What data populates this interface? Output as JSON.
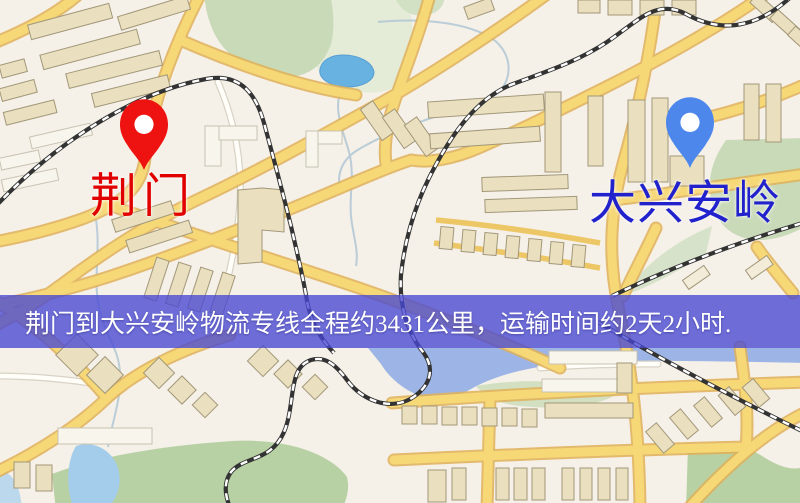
{
  "map": {
    "markers": [
      {
        "role": "origin",
        "name": "荆门",
        "pin_color": "#ee1311",
        "label_color": "#e10000",
        "pin_icon": "red-map-pin"
      },
      {
        "role": "destination",
        "name": "大兴安岭",
        "pin_color": "#4e87ec",
        "label_color": "#2222cc",
        "pin_icon": "blue-map-pin"
      }
    ],
    "banner": {
      "text": "荆门到大兴安岭物流专线全程约3431公里，运输时间约2天2小时.",
      "distance_km": "3431",
      "transit_time": "2天2小时",
      "background": "#4848d4",
      "text_color": "#ffffff"
    },
    "colors": {
      "land": "#f5f0e8",
      "road": "#f6d877",
      "road_casing": "#e0b158",
      "water": "#68b2e2",
      "river": "#9db5e6",
      "park": "#c9dab8",
      "field": "#b7d1a4",
      "railway": "#333333",
      "building": "#eae0bf"
    }
  }
}
